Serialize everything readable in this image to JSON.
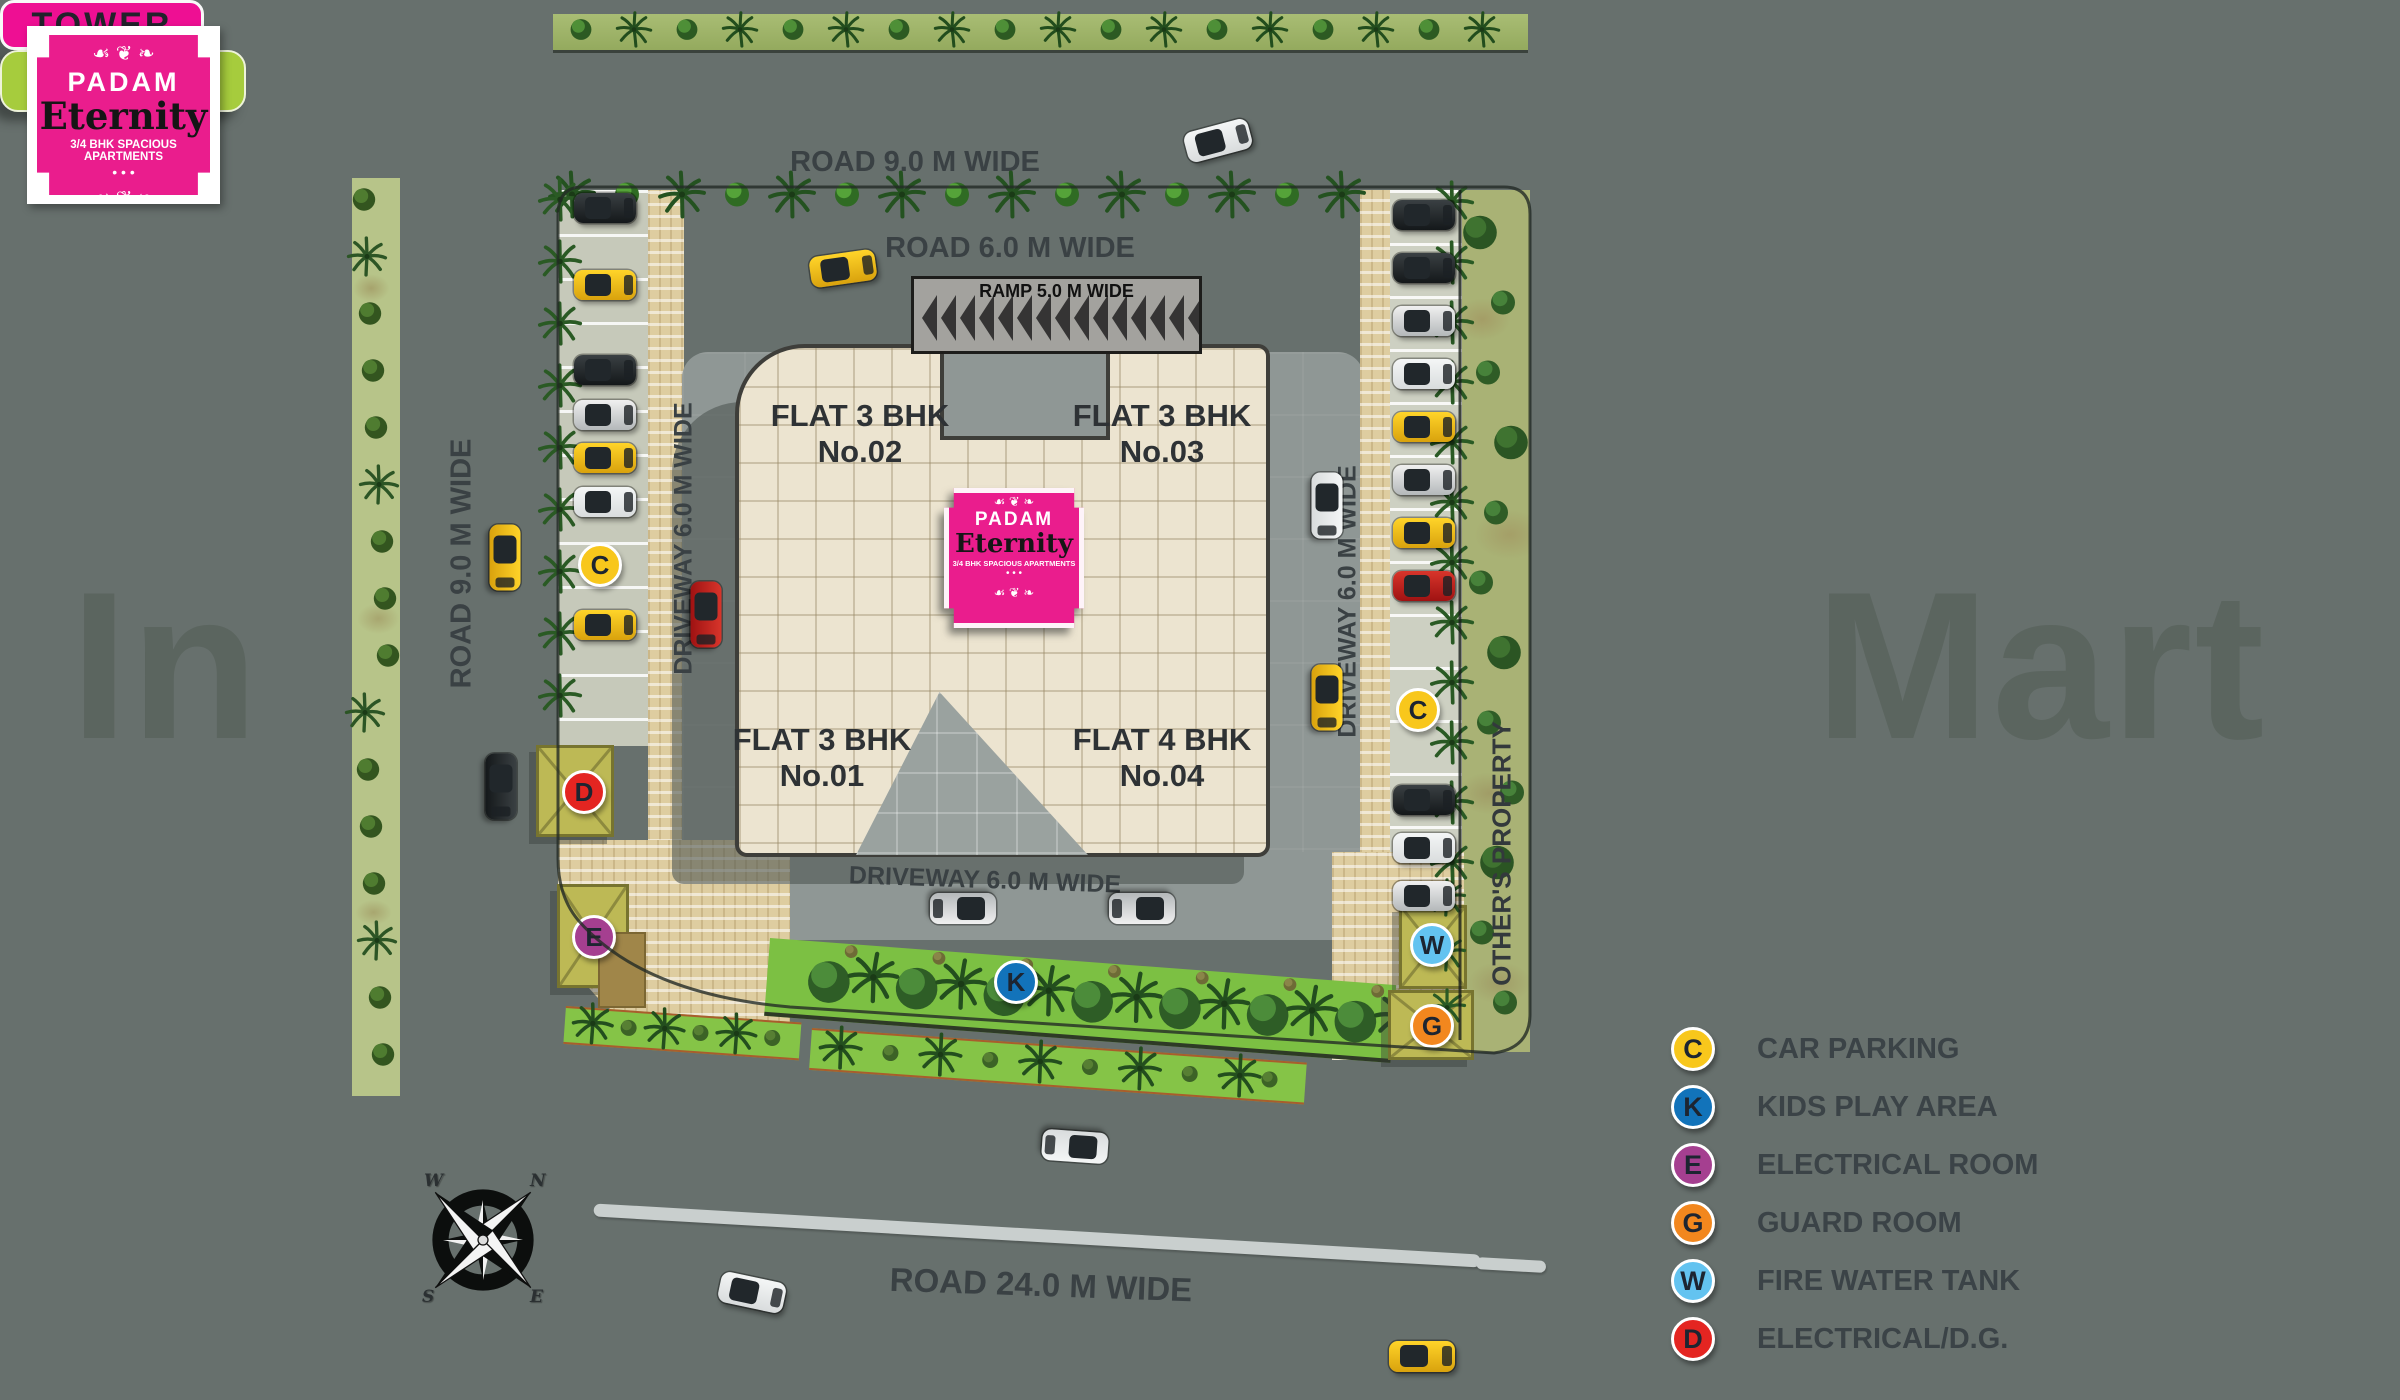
{
  "watermark": {
    "left_fragment": "In",
    "right_fragment": "Mart"
  },
  "site_plan_button": {
    "label": "Site Plan"
  },
  "logo": {
    "brand": "PADAM",
    "name": "Eternity",
    "tagline": "3/4 BHK SPACIOUS APARTMENTS",
    "ornament": "☙ ❦ ❧",
    "dots": "• • •"
  },
  "labels": {
    "road_top": "ROAD 9.0 M WIDE",
    "road_inner": "ROAD 6.0 M WIDE",
    "ramp": "RAMP 5.0 M WIDE",
    "road_left": "ROAD 9.0 M WIDE",
    "road_bottom": "ROAD 24.0 M WIDE",
    "driveway_left": "DRIVEWAY 6.0 M WIDE",
    "driveway_right": "DRIVEWAY 6.0 M WIDE",
    "driveway_bottom": "DRIVEWAY 6.0 M WIDE",
    "others_property": "OTHER'S PROPERTY",
    "tower": "TOWER"
  },
  "flats": [
    {
      "line1": "FLAT 3 BHK",
      "line2": "No.02"
    },
    {
      "line1": "FLAT 3 BHK",
      "line2": "No.03"
    },
    {
      "line1": "FLAT 3 BHK",
      "line2": "No.01"
    },
    {
      "line1": "FLAT 4 BHK",
      "line2": "No.04"
    }
  ],
  "legend": [
    {
      "letter": "C",
      "label": "CAR PARKING",
      "color": "#f8c71c"
    },
    {
      "letter": "K",
      "label": "KIDS PLAY AREA",
      "color": "#1273ba"
    },
    {
      "letter": "E",
      "label": "ELECTRICAL ROOM",
      "color": "#a53f90"
    },
    {
      "letter": "G",
      "label": "GUARD ROOM",
      "color": "#f2871e"
    },
    {
      "letter": "W",
      "label": "FIRE WATER TANK",
      "color": "#63c3f0"
    },
    {
      "letter": "D",
      "label": "ELECTRICAL/D.G.",
      "color": "#e42521"
    }
  ],
  "map_markers": [
    {
      "letter": "C",
      "x": 600,
      "y": 565
    },
    {
      "letter": "C",
      "x": 1418,
      "y": 710
    },
    {
      "letter": "K",
      "x": 1016,
      "y": 982
    },
    {
      "letter": "E",
      "x": 594,
      "y": 937
    },
    {
      "letter": "D",
      "x": 584,
      "y": 792
    },
    {
      "letter": "W",
      "x": 1432,
      "y": 945
    },
    {
      "letter": "G",
      "x": 1432,
      "y": 1026
    }
  ],
  "compass": {
    "n": "N",
    "e": "E",
    "s": "S",
    "w": "W"
  }
}
